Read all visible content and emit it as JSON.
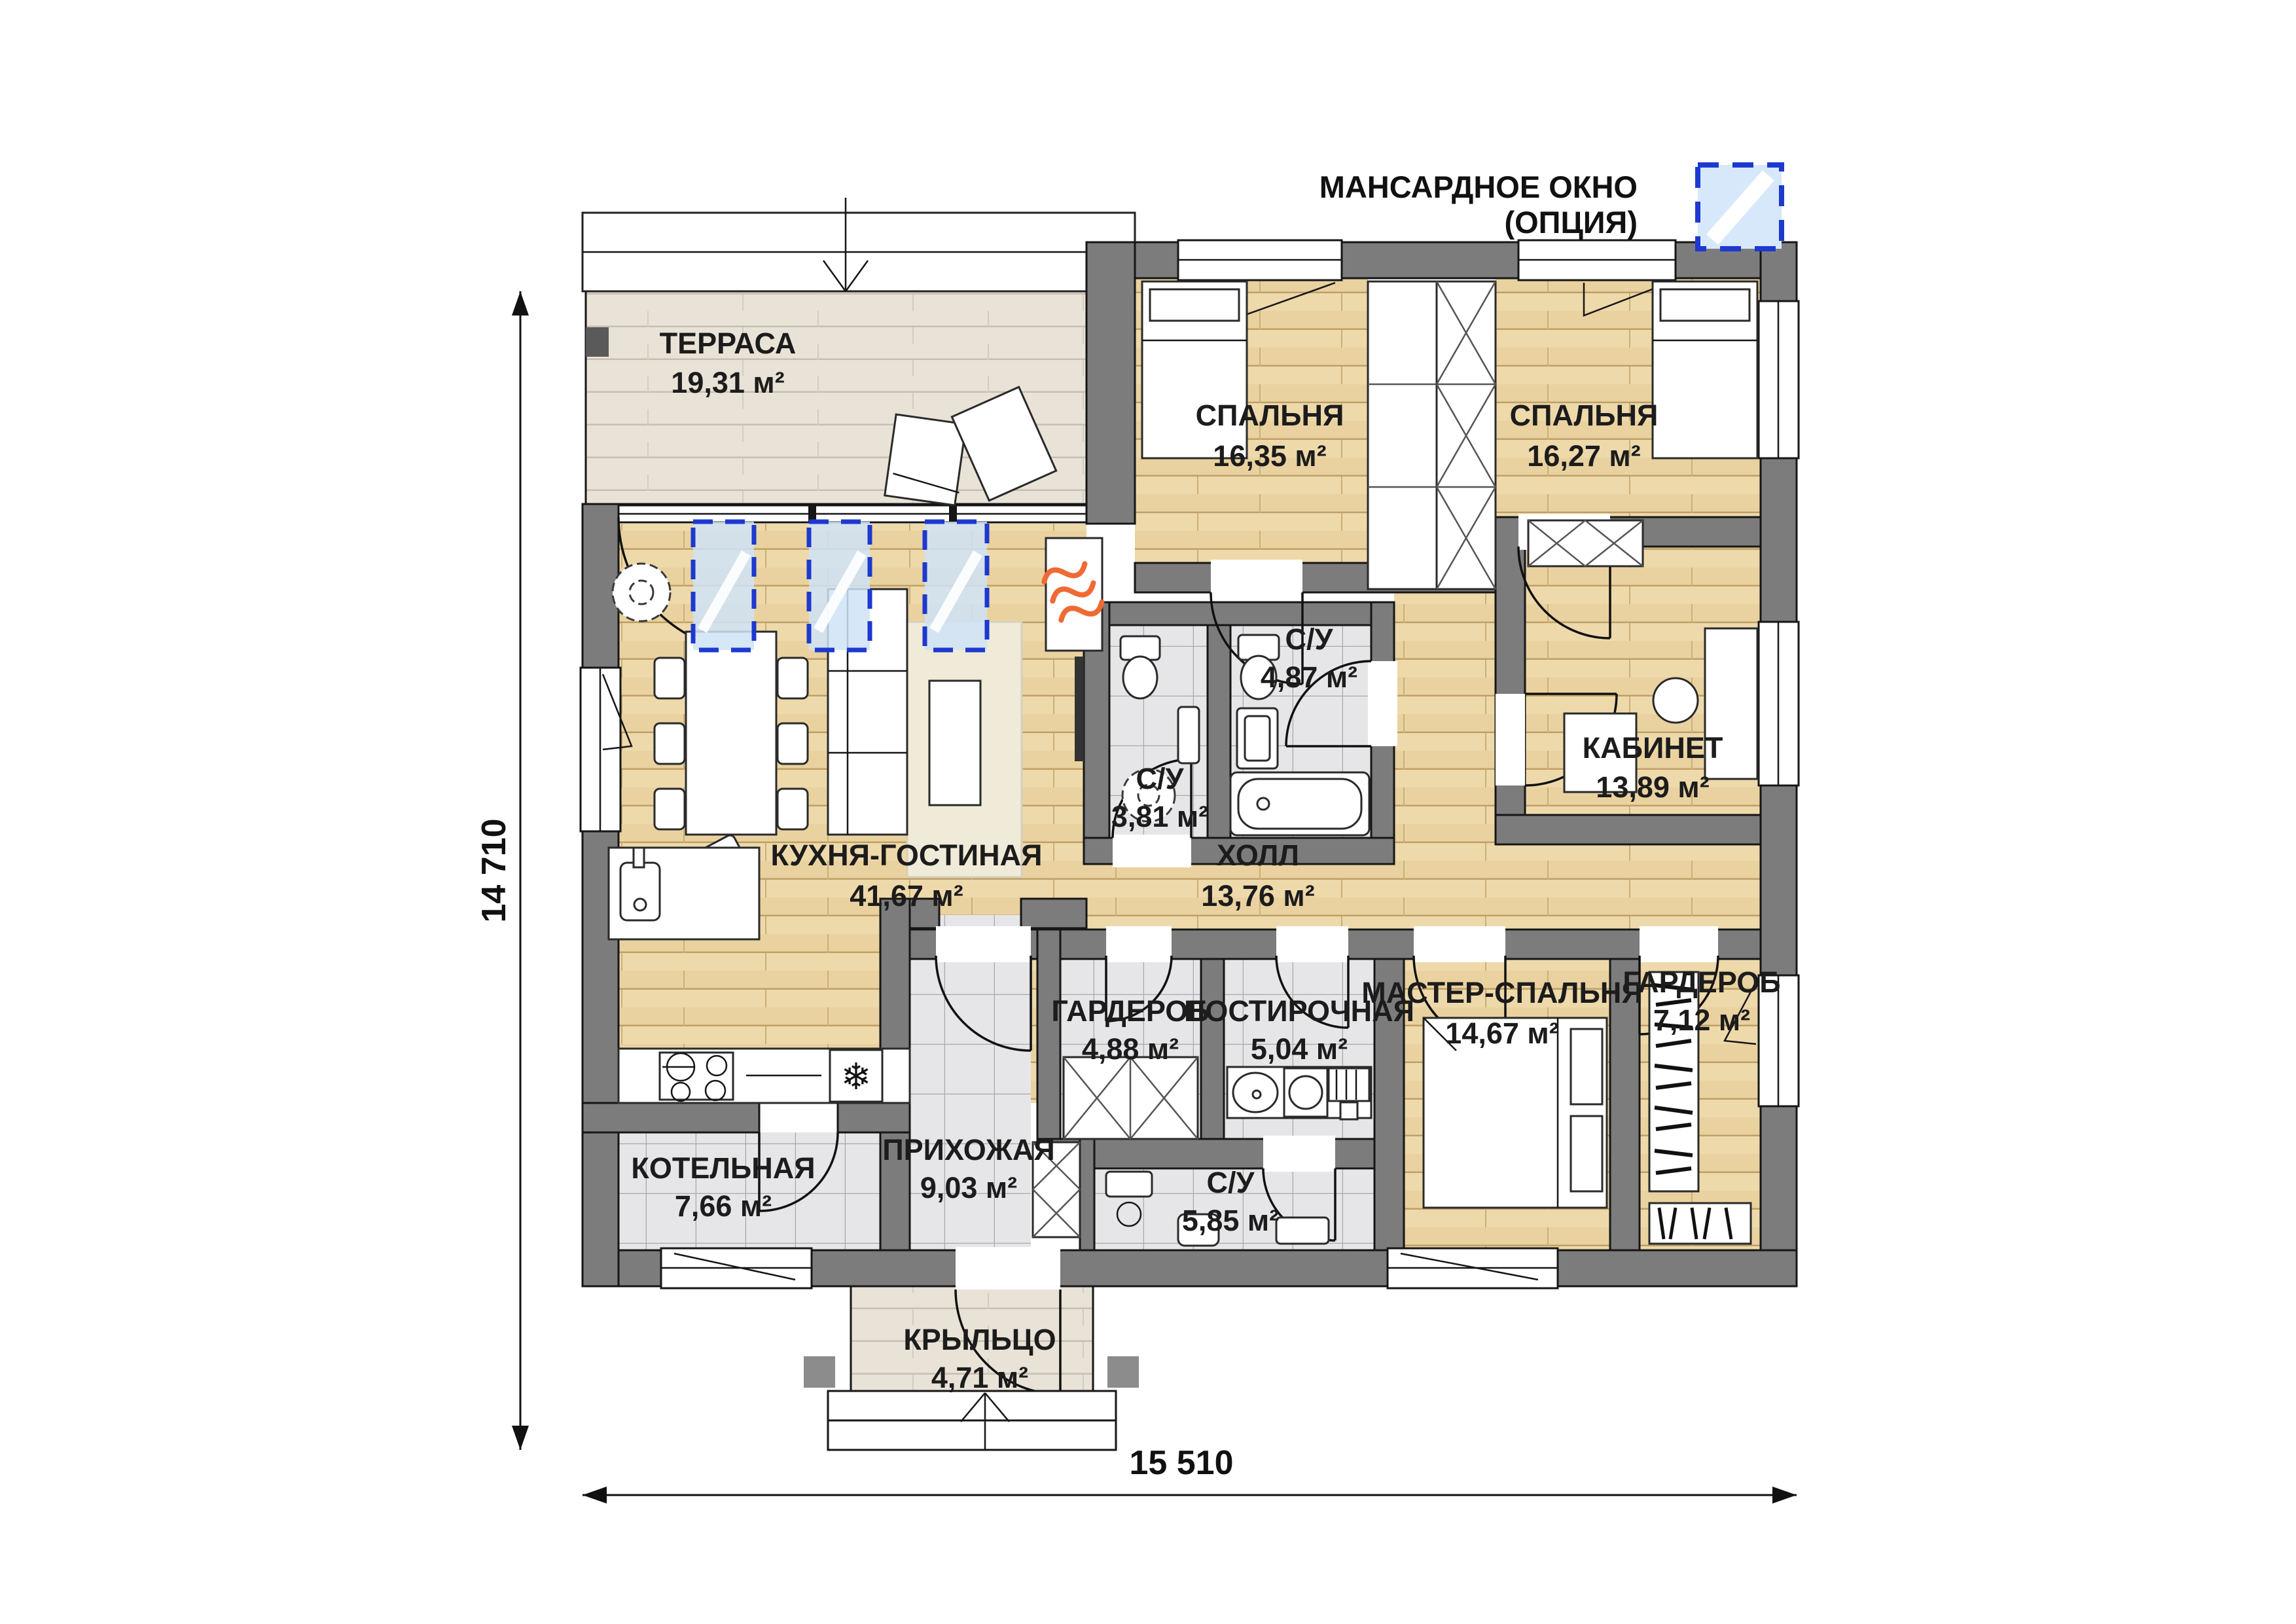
{
  "legend": {
    "line1": "МАНСАРДНОЕ ОКНО",
    "line2": "(ОПЦИЯ)"
  },
  "dimensions": {
    "height": "14 710",
    "width": "15 510"
  },
  "rooms": [
    {
      "id": "terrace",
      "name": "ТЕРРАСА",
      "area": "19,31 м²"
    },
    {
      "id": "bedroom-1",
      "name": "СПАЛЬНЯ",
      "area": "16,35 м²"
    },
    {
      "id": "bedroom-2",
      "name": "СПАЛЬНЯ",
      "area": "16,27 м²"
    },
    {
      "id": "bathroom-1",
      "name": "С/У",
      "area": "4,87 м²"
    },
    {
      "id": "bathroom-2",
      "name": "С/У",
      "area": "3,81 м²"
    },
    {
      "id": "office",
      "name": "КАБИНЕТ",
      "area": "13,89 м²"
    },
    {
      "id": "kitchen-living",
      "name": "КУХНЯ-ГОСТИНАЯ",
      "area": "41,67 м²"
    },
    {
      "id": "hall",
      "name": "ХОЛЛ",
      "area": "13,76 м²"
    },
    {
      "id": "wardrobe-1",
      "name": "ГАРДЕРОБ",
      "area": "4,88 м²"
    },
    {
      "id": "laundry",
      "name": "ПОСТИРОЧНАЯ",
      "area": "5,04 м²"
    },
    {
      "id": "master-bedroom",
      "name": "МАСТЕР-СПАЛЬНЯ",
      "area": "14,67 м²"
    },
    {
      "id": "wardrobe-2",
      "name": "ГАРДЕРОБ",
      "area": "7,12 м²"
    },
    {
      "id": "boiler-room",
      "name": "КОТЕЛЬНАЯ",
      "area": "7,66 м²"
    },
    {
      "id": "entry-hall",
      "name": "ПРИХОЖАЯ",
      "area": "9,03 м²"
    },
    {
      "id": "bathroom-3",
      "name": "С/У",
      "area": "5,85 м²"
    },
    {
      "id": "porch",
      "name": "КРЫЛЬЦО",
      "area": "4,71 м²"
    }
  ],
  "icons": {
    "fridge_glyph": "❄"
  },
  "colors": {
    "wall": "#7c7c7c",
    "wood_floor": "#e9d2a0",
    "deck_floor": "#e9e2d7",
    "tile_floor": "#e6e6e9",
    "option_blue": "#1d39cf",
    "option_glass": "#d7e8fa",
    "heater_orange": "#ef6a35"
  }
}
